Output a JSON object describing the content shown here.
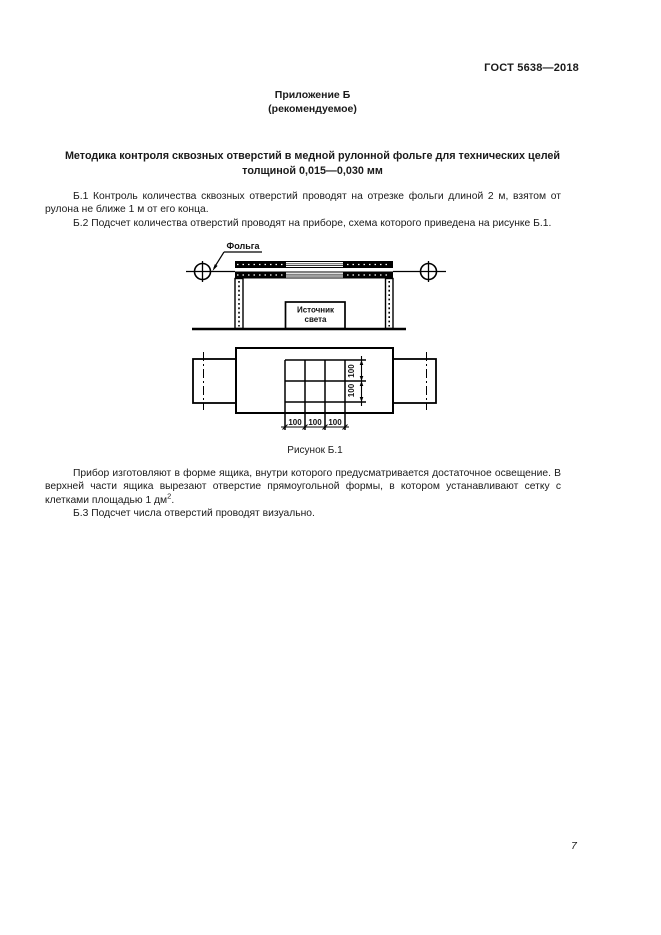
{
  "page": {
    "doc_code": "ГОСТ 5638—2018",
    "page_number": "7"
  },
  "appendix": {
    "label": "Приложение Б",
    "note": "(рекомендуемое)"
  },
  "title": {
    "line1": "Методика контроля сквозных отверстий в медной рулонной фольге для технических целей",
    "line2": "толщиной 0,015—0,030 мм"
  },
  "paragraphs": {
    "b1": "Б.1 Контроль количества сквозных отверстий проводят на отрезке фольги длиной 2 м, взятом от рулона не ближе 1 м от его конца.",
    "b2": "Б.2 Подсчет количества отверстий проводят на приборе, схема которого приведена на рисунке Б.1.",
    "desc_main": "Прибор изготовляют в форме ящика, внутри которого предусматривается достаточное освещение. В верхней части ящика вырезают отверстие прямоугольной формы, в котором устанавливают сетку с клетками площадью 1 дм",
    "desc_sup": "2",
    "desc_tail": ".",
    "b3": "Б.3 Подсчет числа отверстий проводят визуально."
  },
  "figure": {
    "caption": "Рисунок Б.1",
    "foil_label": "Фольга",
    "light_source_line1": "Источник",
    "light_source_line2": "света",
    "dim_value": "100"
  }
}
